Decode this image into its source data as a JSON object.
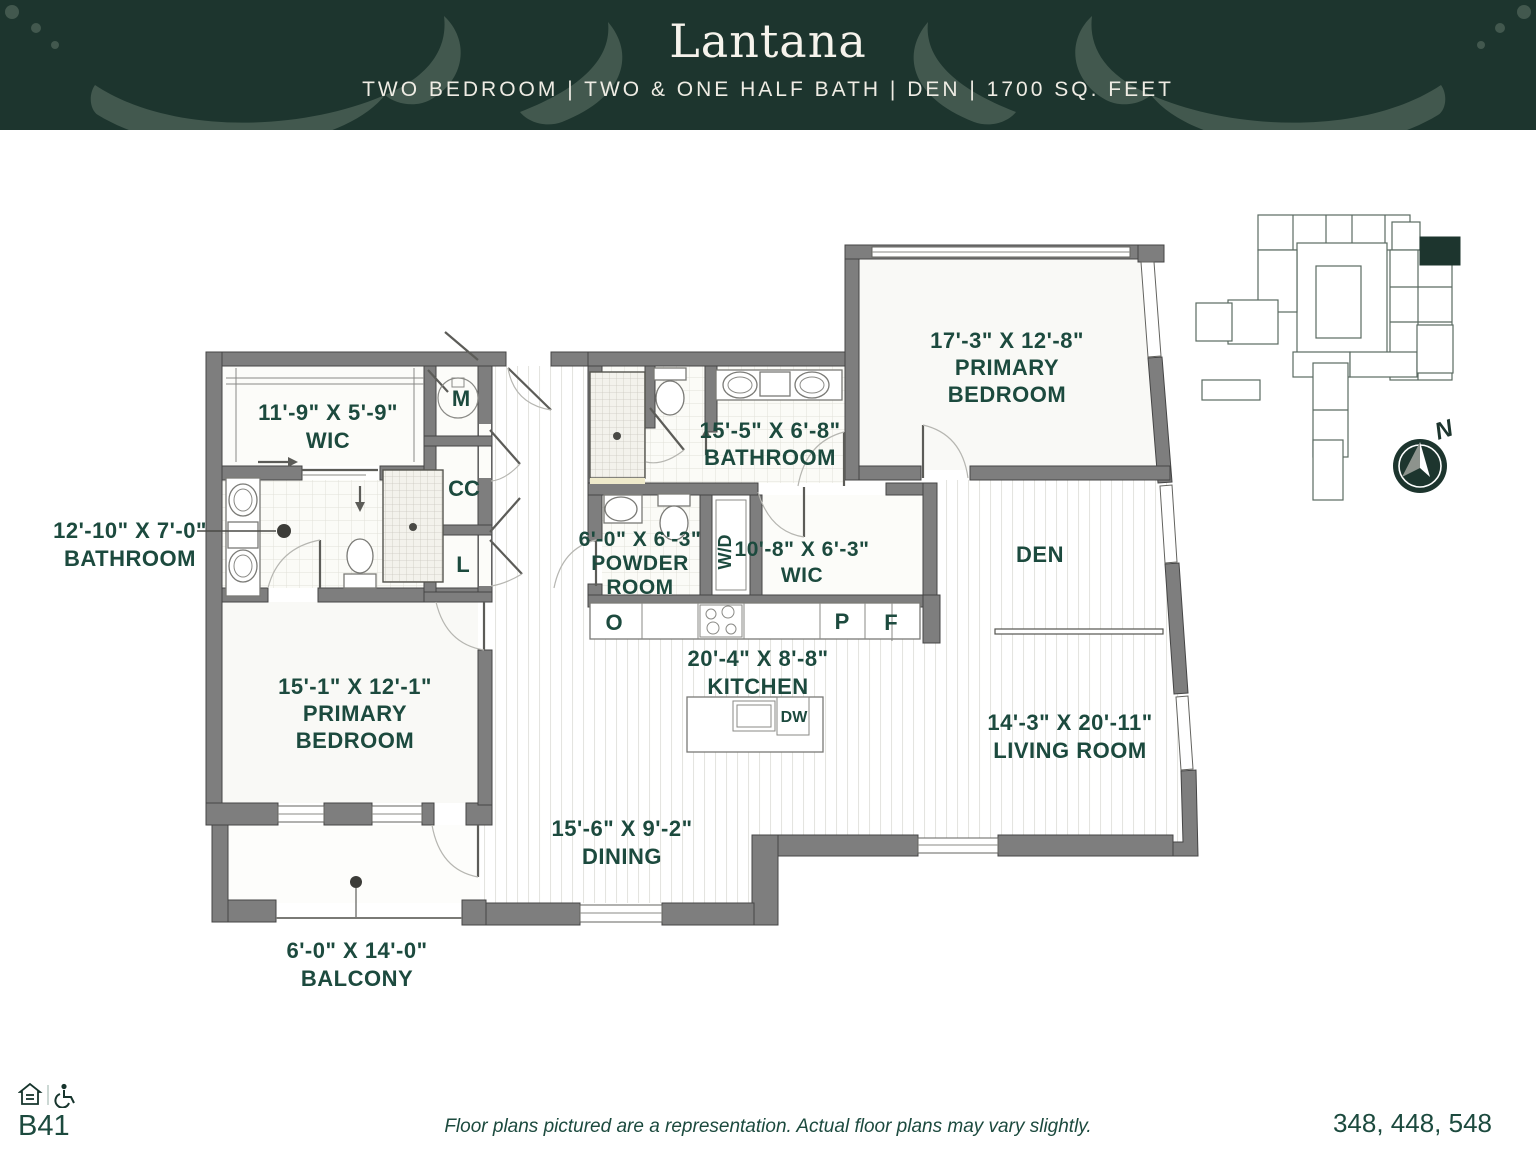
{
  "header": {
    "title": "Lantana",
    "subtitle": "TWO BEDROOM | TWO & ONE HALF BATH | DEN | 1700 SQ. FEET"
  },
  "colors": {
    "header_bg": "#1d352e",
    "flourish": "#42584e",
    "accent_green": "#1c4a3e",
    "wall_gray": "#7e7e7e",
    "highlight_unit": "#1d352e"
  },
  "plan": {
    "rooms": {
      "wic1": {
        "lines": [
          "11'-9\" X 5'-9\"",
          "WIC"
        ]
      },
      "bath1": {
        "lines": [
          "12'-10\" X 7'-0\"",
          "BATHROOM"
        ]
      },
      "primary1": {
        "lines": [
          "17'-3\" X 12'-8\"",
          "PRIMARY",
          "BEDROOM"
        ]
      },
      "bath2": {
        "lines": [
          "15'-5\" X 6'-8\"",
          "BATHROOM"
        ]
      },
      "powder": {
        "lines": [
          "6'-0\" X 6'-3\"",
          "POWDER",
          "ROOM"
        ]
      },
      "wic2": {
        "lines": [
          "10'-8\" X 6'-3\"",
          "WIC"
        ]
      },
      "den": {
        "lines": [
          "DEN"
        ]
      },
      "kitchen": {
        "lines": [
          "20'-4\" X 8'-8\"",
          "KITCHEN"
        ]
      },
      "living": {
        "lines": [
          "14'-3\" X 20'-11\"",
          "LIVING ROOM"
        ]
      },
      "dining": {
        "lines": [
          "15'-6\" X 9'-2\"",
          "DINING"
        ]
      },
      "primary2": {
        "lines": [
          "15'-1\" X 12'-1\"",
          "PRIMARY",
          "BEDROOM"
        ]
      },
      "balcony": {
        "lines": [
          "6'-0\" X 14'-0\"",
          "BALCONY"
        ]
      }
    },
    "markers": {
      "mechanical": "M",
      "coat_closet": "CC",
      "linen": "L",
      "washer_dryer": "W/D",
      "oven": "O",
      "pantry": "P",
      "fridge": "F",
      "dishwasher": "DW"
    },
    "compass_north": "N"
  },
  "footer": {
    "plan_code": "B41",
    "disclaimer": "Floor plans pictured are a representation. Actual floor plans may vary slightly.",
    "unit_numbers": "348, 448, 548"
  }
}
